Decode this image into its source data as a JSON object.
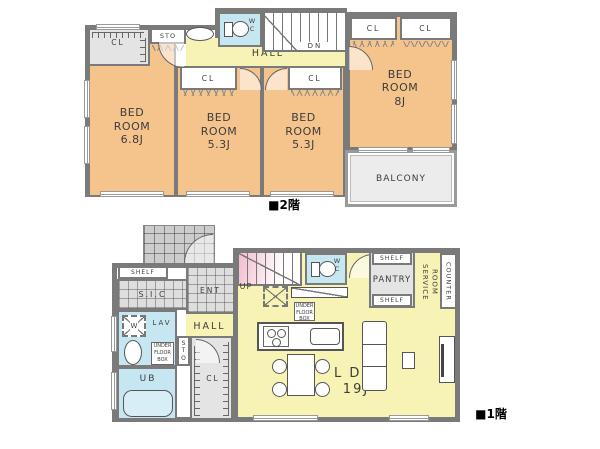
{
  "colors": {
    "bedroom": "#f5c48c",
    "living": "#f7f3b5",
    "wet_area": "#c6e6f2",
    "wall": "#7a7a7a",
    "closet": "#e4e4e4",
    "balcony": "#ececec",
    "stair_pink": "#f2bacd"
  },
  "floor2": {
    "label": "■2階",
    "rooms": {
      "bedroom_68": "BED\nROOM\n6.8J",
      "bedroom_53a": "BED\nROOM\n5.3J",
      "bedroom_53b": "BED\nROOM\n5.3J",
      "bedroom_8": "BED\nROOM\n8J",
      "hall": "HALL",
      "balcony": "BALCONY",
      "wc": "W\nC",
      "sto": "STO",
      "cl": "CL",
      "dn": "DN"
    }
  },
  "floor1": {
    "label": "■1階",
    "rooms": {
      "ldk": "L D K\n19J",
      "hall": "HALL",
      "ent": "ENT",
      "sic": "S.I.C",
      "shelf": "SHELF",
      "up": "UP",
      "wc": "W\nC",
      "lav": "LAV",
      "washer": "W",
      "sto": "S\nT\nO",
      "ub": "UB",
      "cl": "CL",
      "pantry": "PANTRY",
      "service_room": "SERVICE\nROOM",
      "counter": "COUNTER",
      "under_floor_box": "UNDER\nFLOOR\nBOX"
    }
  }
}
